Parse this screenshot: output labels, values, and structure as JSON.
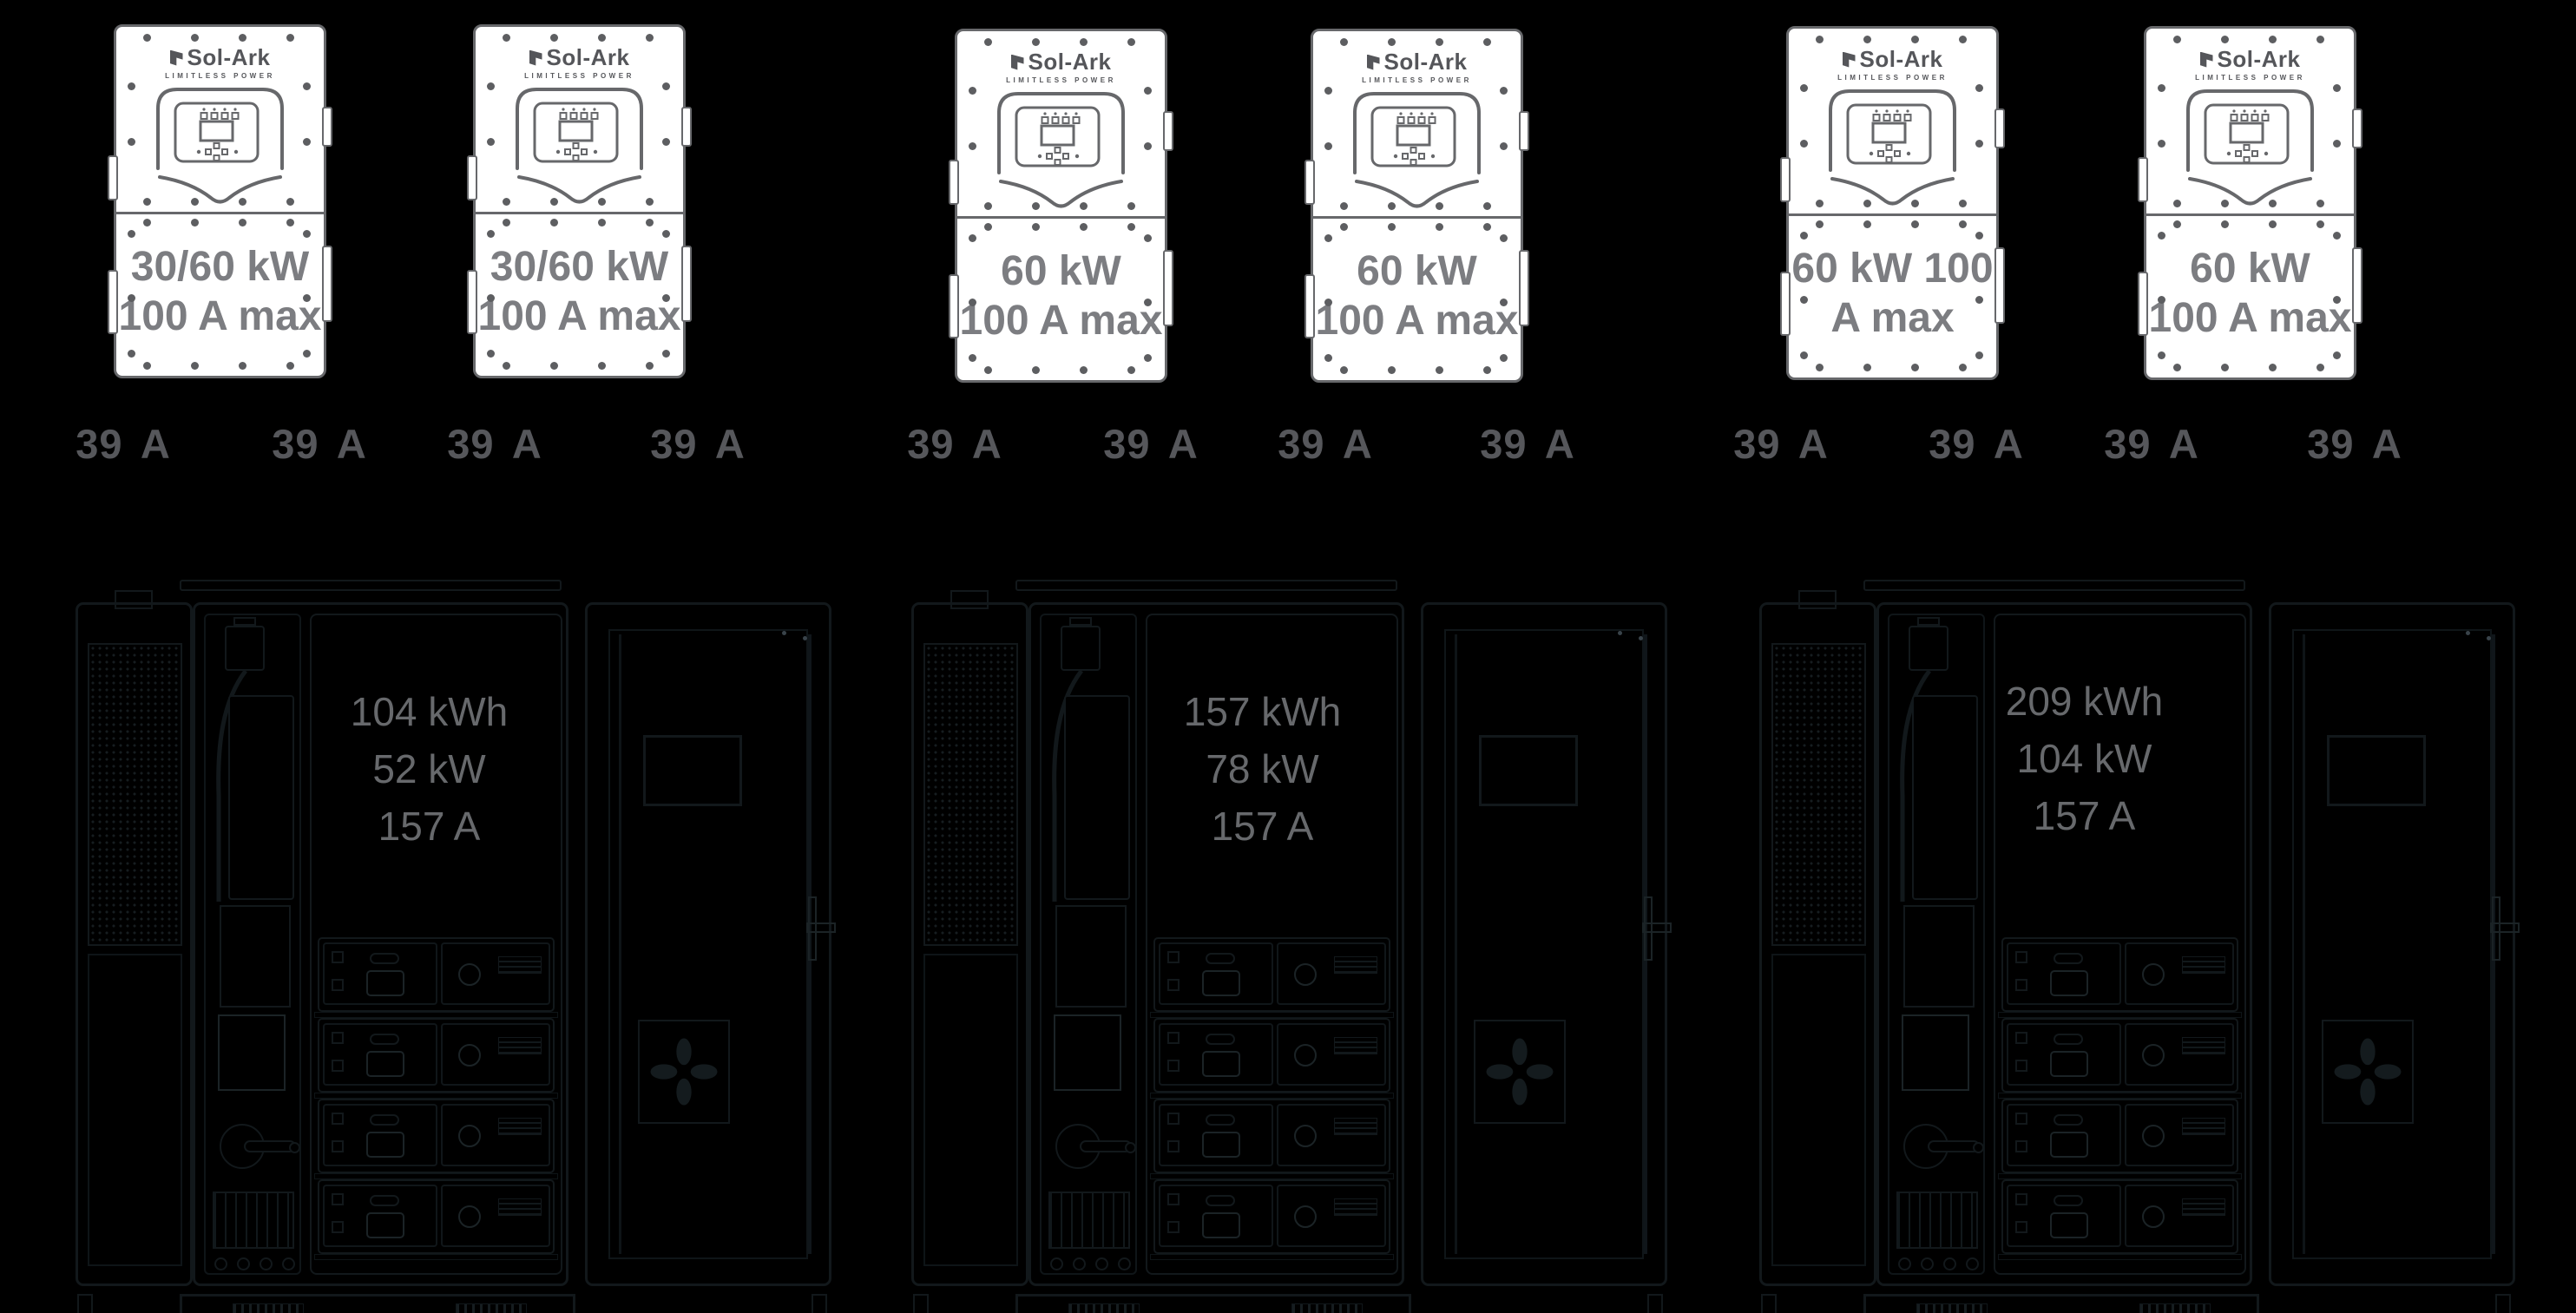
{
  "brand": {
    "logo_text": "Sol-Ark",
    "logo_tagline": "LIMITLESS POWER"
  },
  "inverters": [
    {
      "lines": [
        "30/60 kW",
        "100 A max"
      ]
    },
    {
      "lines": [
        "30/60 kW",
        "100 A max"
      ]
    },
    {
      "lines": [
        "60 kW",
        "100 A max"
      ]
    },
    {
      "lines": [
        "60 kW",
        "100 A max"
      ]
    },
    {
      "lines": [
        "60 kW 100",
        "A max"
      ]
    },
    {
      "lines": [
        "60 kW",
        "100 A max"
      ]
    }
  ],
  "amp_labels": [
    "39 A",
    "39 A",
    "39 A",
    "39 A",
    "39 A",
    "39 A",
    "39 A",
    "39 A",
    "39 A",
    "39 A",
    "39 A",
    "39 A"
  ],
  "battery_banks": [
    {
      "specs": [
        "104 kWh",
        "52 kW",
        "157 A"
      ]
    },
    {
      "specs": [
        "157 kWh",
        "78 kW",
        "157 A"
      ]
    },
    {
      "specs": [
        "209 kWh",
        "104 kW",
        "157 A"
      ]
    }
  ],
  "colors": {
    "background": "#000000",
    "inverter_body": "#ffffff",
    "inverter_line_art": "#67686b",
    "inverter_rating_text": "#7c7d81",
    "amp_label_text": "#56575b",
    "battery_spec_text": "#67696c",
    "cabinet_line_art": "#12181b"
  }
}
